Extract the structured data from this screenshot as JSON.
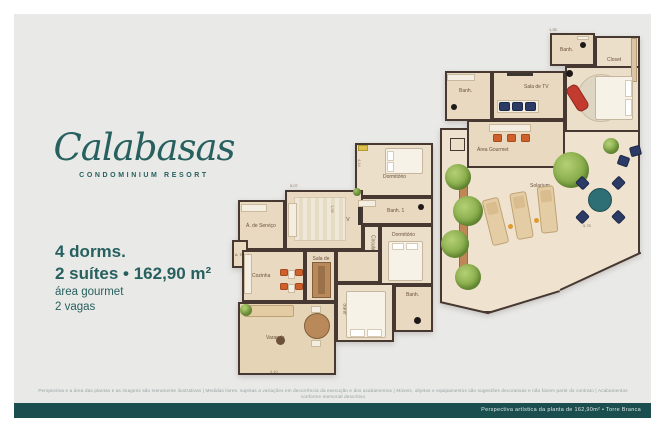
{
  "logo": {
    "name": "Calabasas",
    "subtitle": "CONDOMINIUM RESORT"
  },
  "specs": {
    "dorms": "4 dorms.",
    "suites": "2 suítes • 162,90 m²",
    "gourmet": "área gourmet",
    "vagas": "2 vagas"
  },
  "plans": {
    "main": {
      "rooms": {
        "dormitorio1": "Dormitório",
        "banh1": "Banh. 1",
        "circulacao": "Circulação",
        "dormitorio2": "Dormitório",
        "banh2": "Banh.",
        "suite": "Suíte",
        "sala_tv": "Sala de TV",
        "servico": "Á. de Serviço",
        "a_tec": "A. Téc.",
        "cozinha": "Cozinha",
        "sala_jantar": "Sala de Jantar",
        "varanda": "Varanda"
      },
      "dims": {
        "d1": "5,07",
        "d2": "4,14",
        "d3": "4,10",
        "d4": "1,99"
      }
    },
    "upper": {
      "rooms": {
        "banh1": "Banh.",
        "closet": "Closet",
        "suite": "Suíte",
        "banh2": "Banh.",
        "sala_tv": "Sala de TV",
        "area_gourmet": "Área Gourmet",
        "solarium": "Solarium"
      },
      "dims": {
        "d1": "1,35",
        "d2": "5,78"
      }
    }
  },
  "footer": {
    "disclaimer": "Perspectiva e a área das plantas e as imagens são meramente ilustrativas | Medidas livres, sujeitas a variações em decorrência da execução e dos acabamentos | Móveis, objetos e equipamentos são sugestões decorativas e não fazem parte do contrato | Acabamentos conforme memorial descritivo",
    "bar_text": "Perspectiva artística da planta de 162,90m² • Torre Branca"
  },
  "colors": {
    "teal": "#27605f",
    "bar": "#1b4e4f",
    "wall": "#473831",
    "floor": "#e8d9c0",
    "orange": "#cf5f2b"
  }
}
